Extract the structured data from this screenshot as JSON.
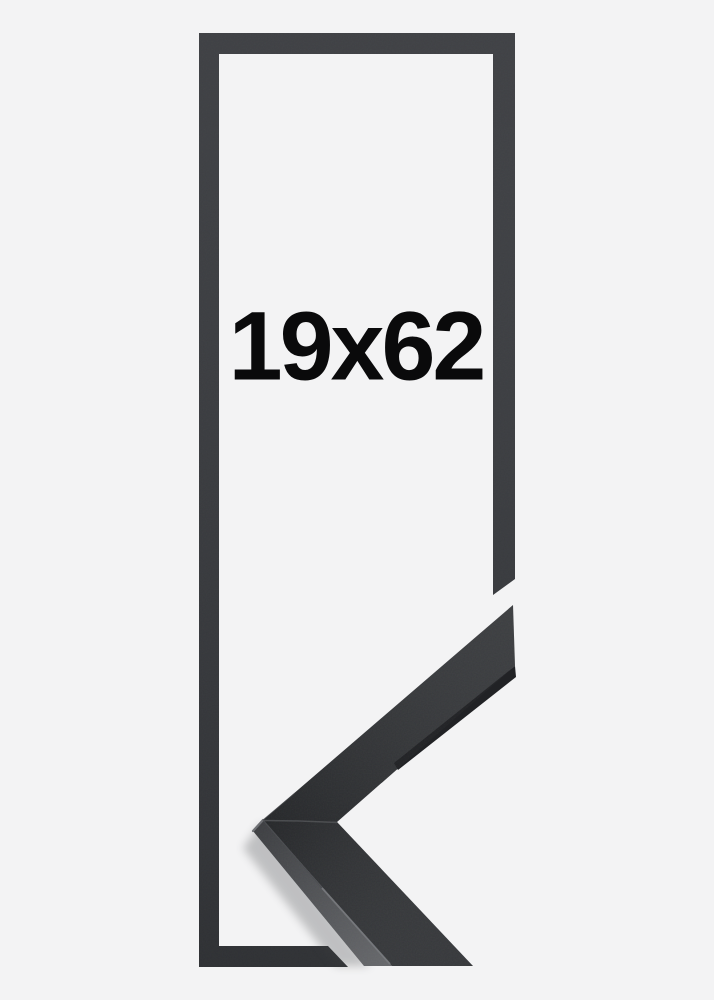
{
  "product": {
    "size_label": "19x62",
    "frame_finish": "black",
    "colors": {
      "background": "#f3f3f4",
      "frame_outline": "#34363a",
      "moulding_face": "#2c2e31",
      "moulding_side": "#4a4c50",
      "bevel_highlight": "#6e7074",
      "label_text": "#0a0a0b"
    }
  }
}
